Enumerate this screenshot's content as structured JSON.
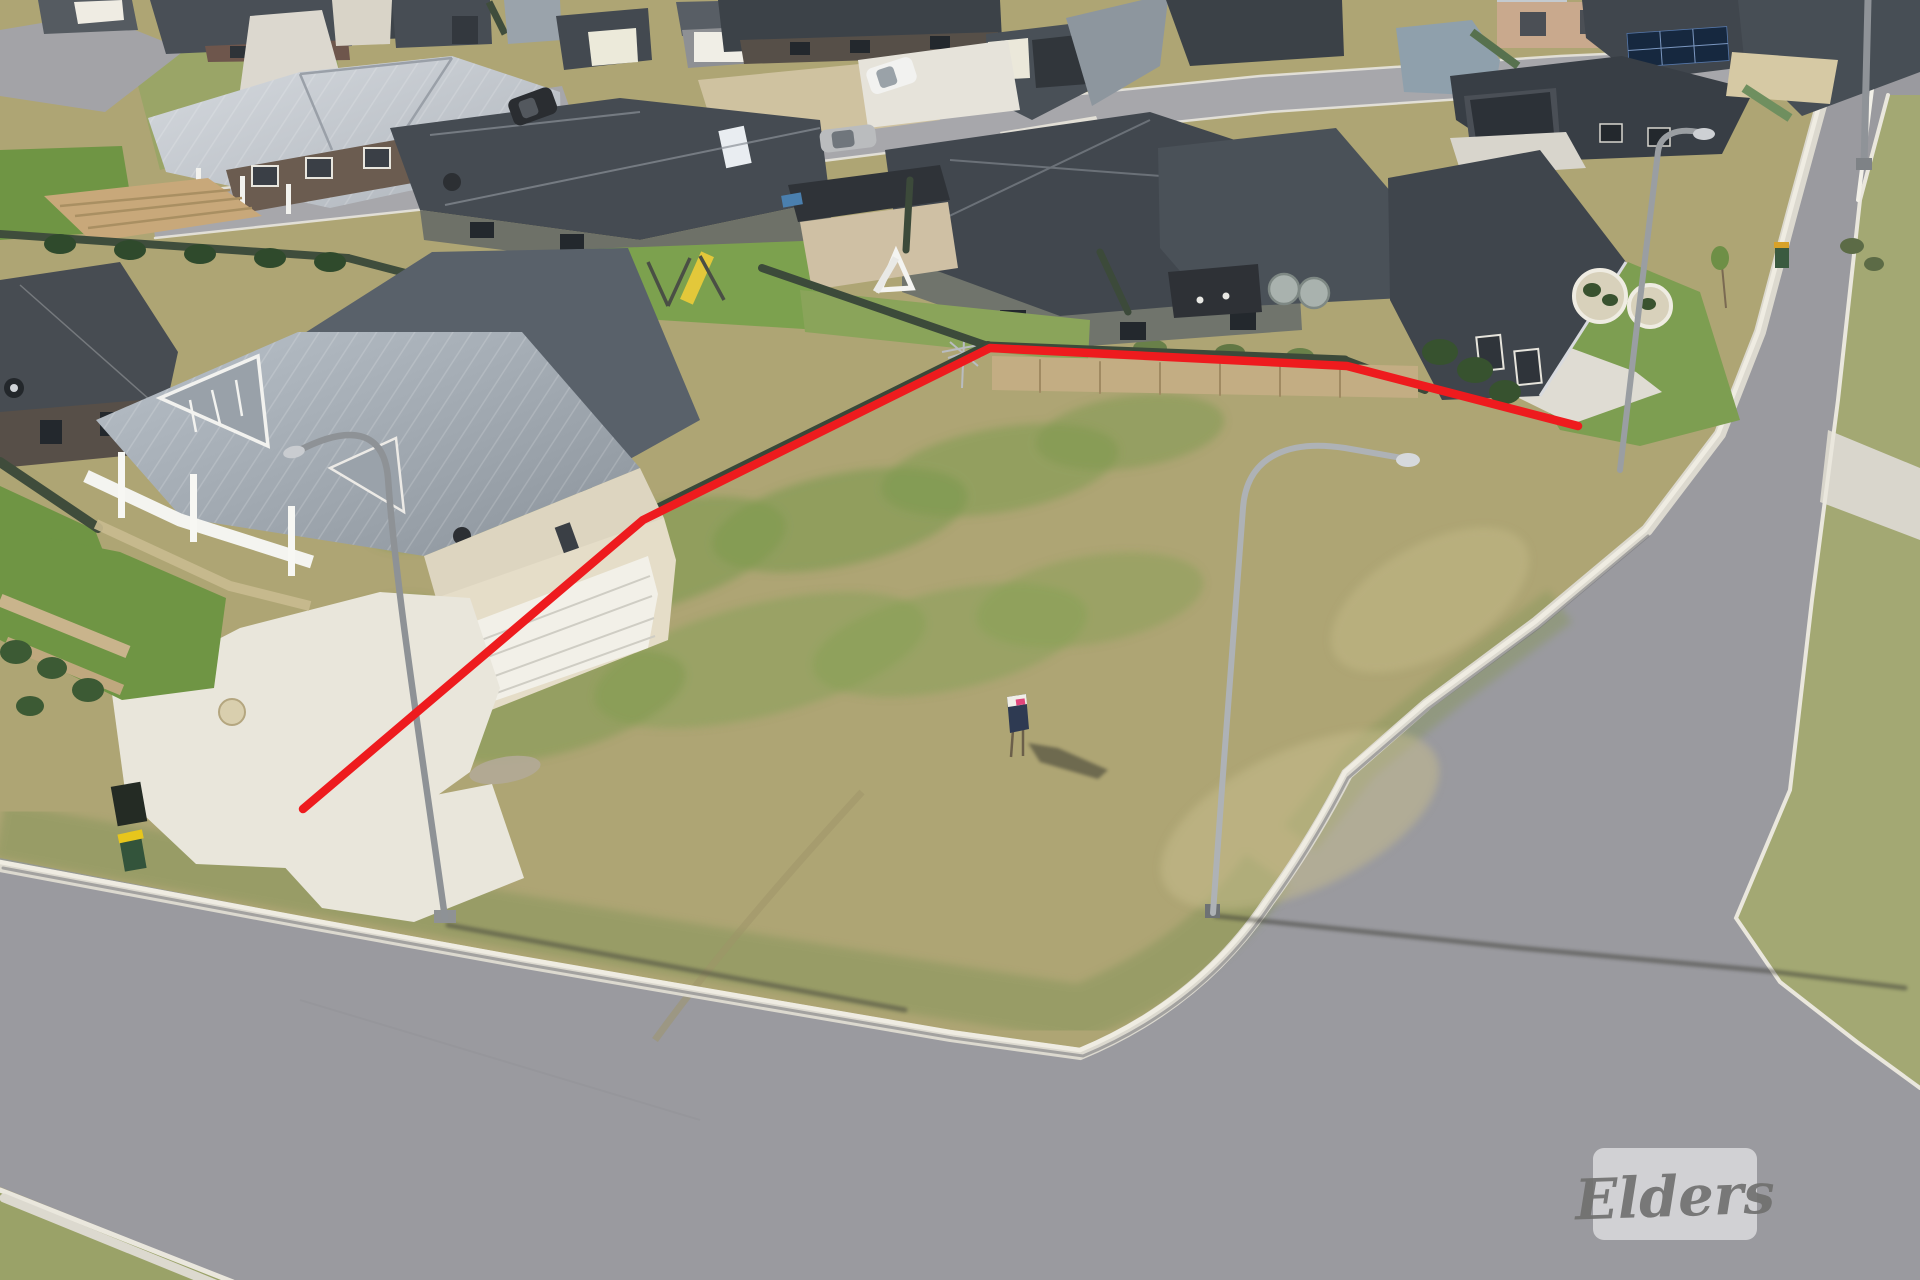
{
  "watermark": {
    "label": "Elders"
  },
  "boundary": {
    "points": "303,809 643,520 990,348 1347,366 1578,426",
    "color": "#ee1b1e",
    "stroke_width": "8.5",
    "meaning": "red outline marking the vacant lot for sale"
  },
  "scene": {
    "description": "Aerial drone photo of a vacant corner block of land in a new housing estate, outlined in red, with surrounding single-storey houses, dark green fences, concrete driveways and an asphalt road junction",
    "colors": {
      "asphalt": "#9a9a9f",
      "asphalt_light": "#a7a7ab",
      "curb": "#eae7dd",
      "dry_grass": "#aea574",
      "green_patch": "#7d9a4e",
      "lawn": "#6f9544",
      "fence_green": "#3e4c3b",
      "roof_dark": "#42484f",
      "roof_silver": "#c9ced4",
      "wall_cream": "#e6dfcb",
      "concrete": "#e8e5da",
      "timber_deck": "#c8a87a",
      "boundary_red": "#ee1b1e",
      "watermark_bg": "rgba(255,255,255,0.55)",
      "watermark_text": "#6f6f6d"
    }
  }
}
